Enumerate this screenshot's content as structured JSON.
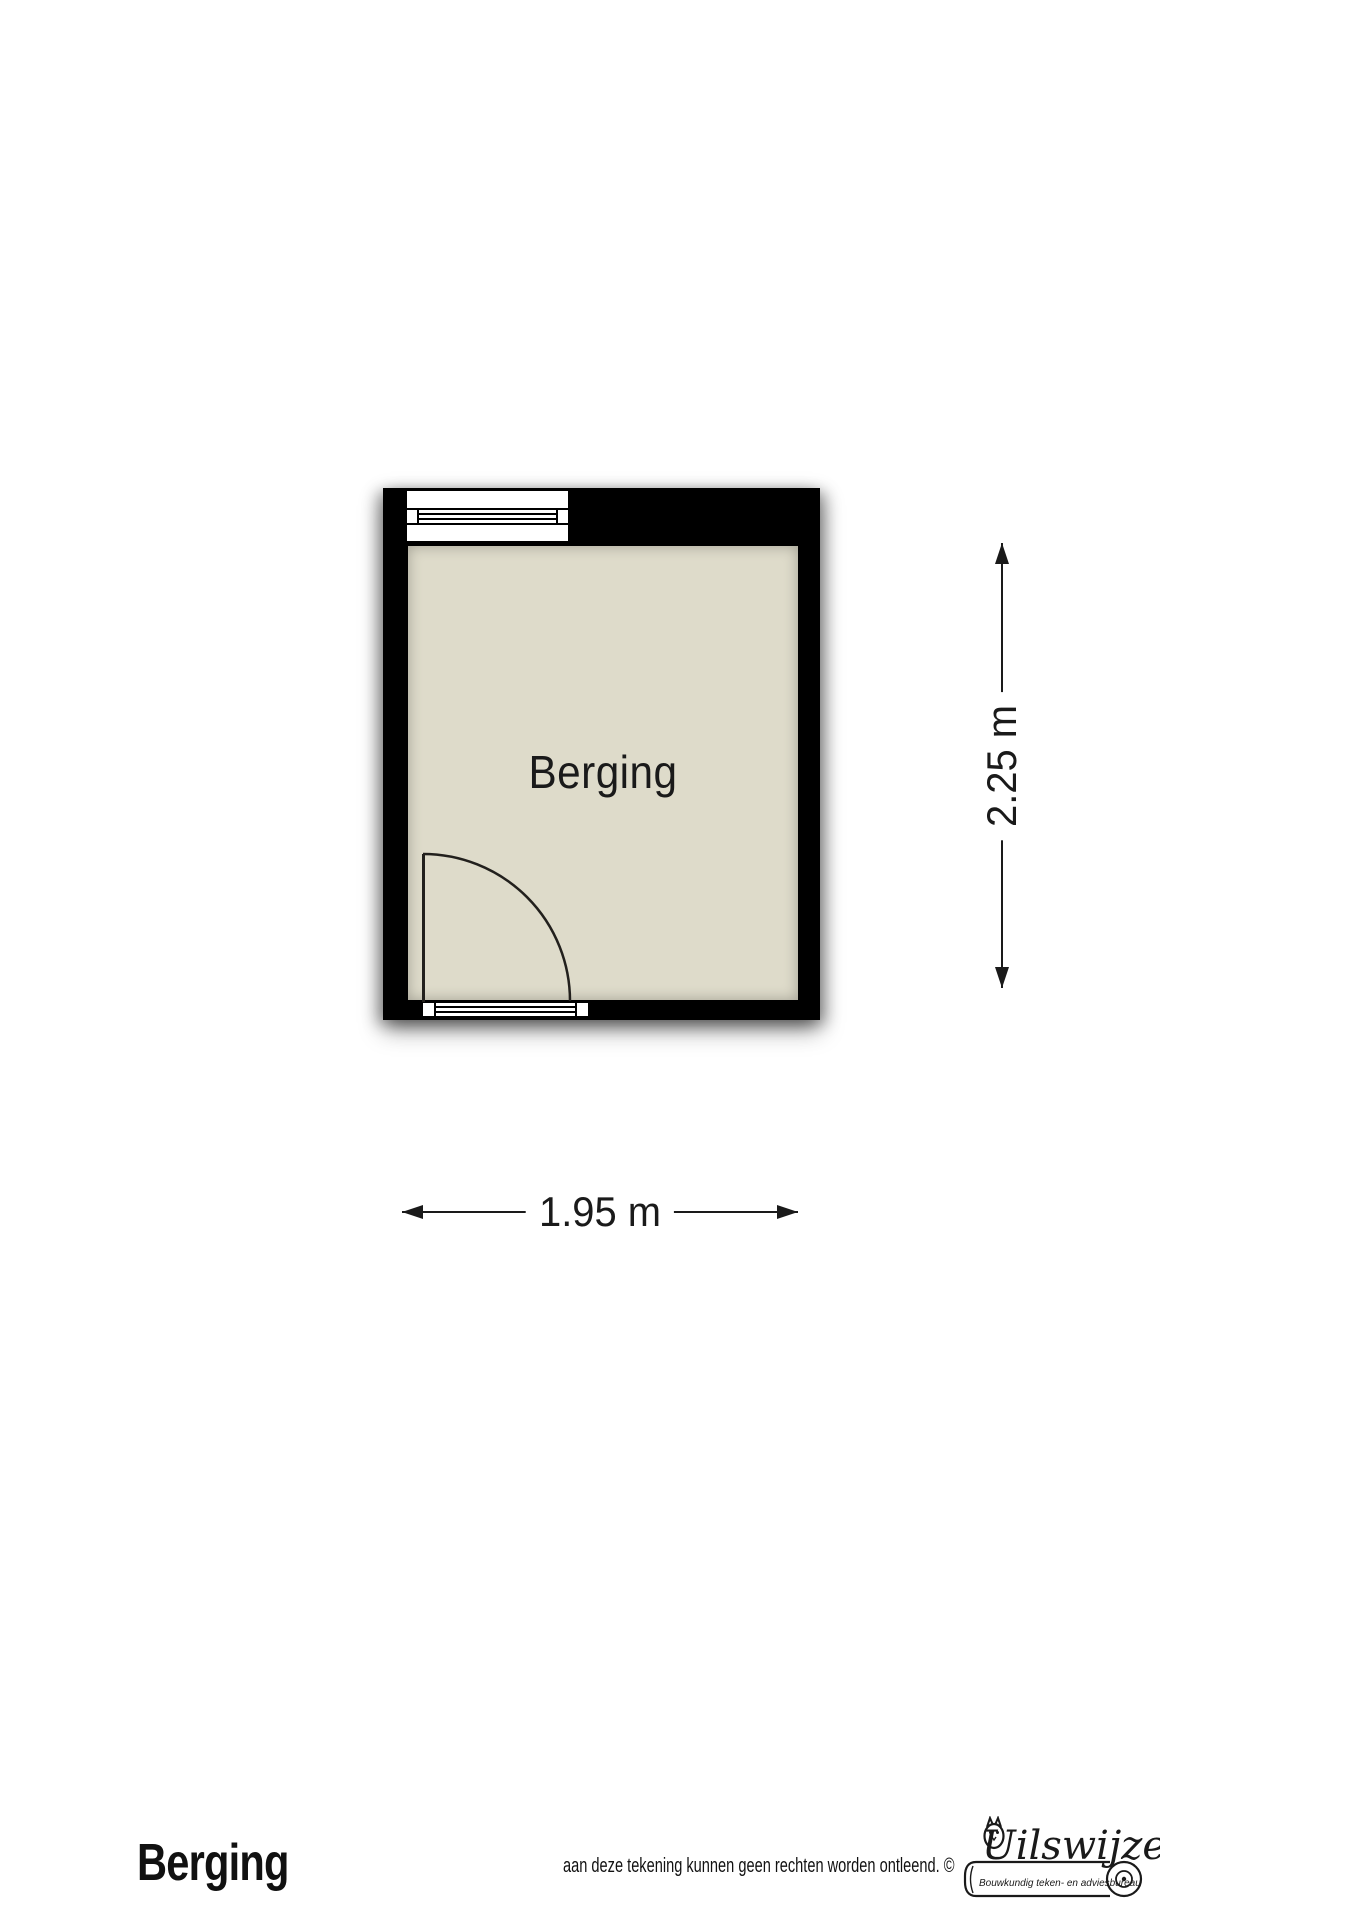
{
  "floorplan": {
    "room_label": "Berging",
    "dim_vertical": "2.25 m",
    "dim_horizontal": "1.95 m",
    "features": [
      "window-top-left",
      "door-bottom-left-quarter-swing"
    ],
    "colors": {
      "wall": "#000000",
      "floor": "#dedbca",
      "line": "#1a1a1a",
      "page": "#ffffff"
    }
  },
  "footer": {
    "title": "Berging",
    "disclaimer": "aan deze tekening kunnen geen rechten worden ontleend. ©",
    "logo": {
      "name": "Uilswijze",
      "subtitle": "Bouwkundig teken- en adviesbureau"
    }
  }
}
